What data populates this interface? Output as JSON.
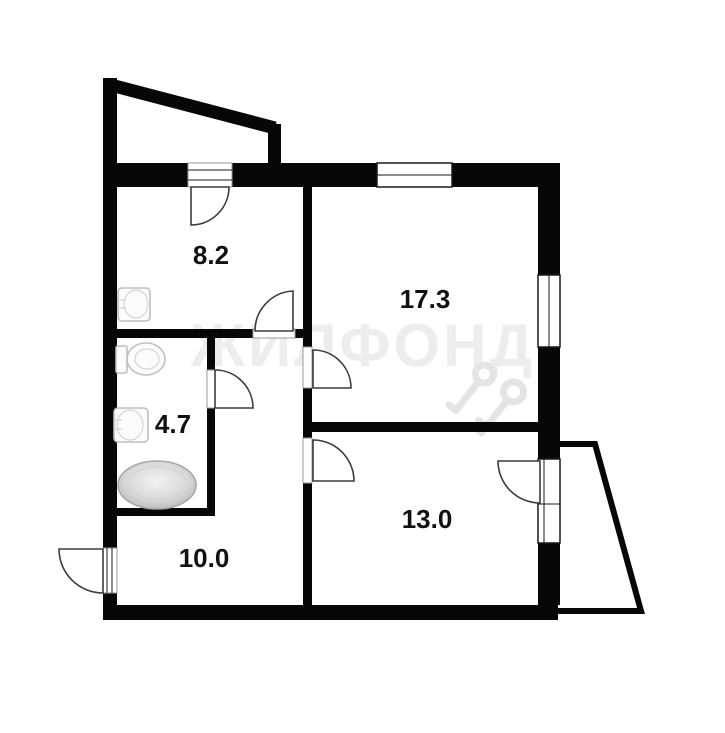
{
  "title": "Apartment floor plan",
  "watermark": {
    "text": "ЖИЛФОНД",
    "color": "#ededed",
    "icon": "keys-icon"
  },
  "rooms": [
    {
      "id": "kitchen",
      "label": "8.2"
    },
    {
      "id": "living-room",
      "label": "17.3"
    },
    {
      "id": "bathroom",
      "label": "4.7"
    },
    {
      "id": "hallway",
      "label": "10.0"
    },
    {
      "id": "bedroom",
      "label": "13.0"
    }
  ],
  "fixtures": [
    {
      "id": "kitchen-sink"
    },
    {
      "id": "toilet"
    },
    {
      "id": "wash-basin"
    },
    {
      "id": "bathtub"
    }
  ],
  "features": [
    {
      "id": "balcony-top-left"
    },
    {
      "id": "balcony-bottom-right"
    },
    {
      "id": "entrance-door"
    }
  ],
  "colors": {
    "wall": "#070707",
    "background": "#ffffff",
    "fixture_gray": "#bfbfbf",
    "label": "#111111",
    "watermark_gray": "#ededed"
  }
}
